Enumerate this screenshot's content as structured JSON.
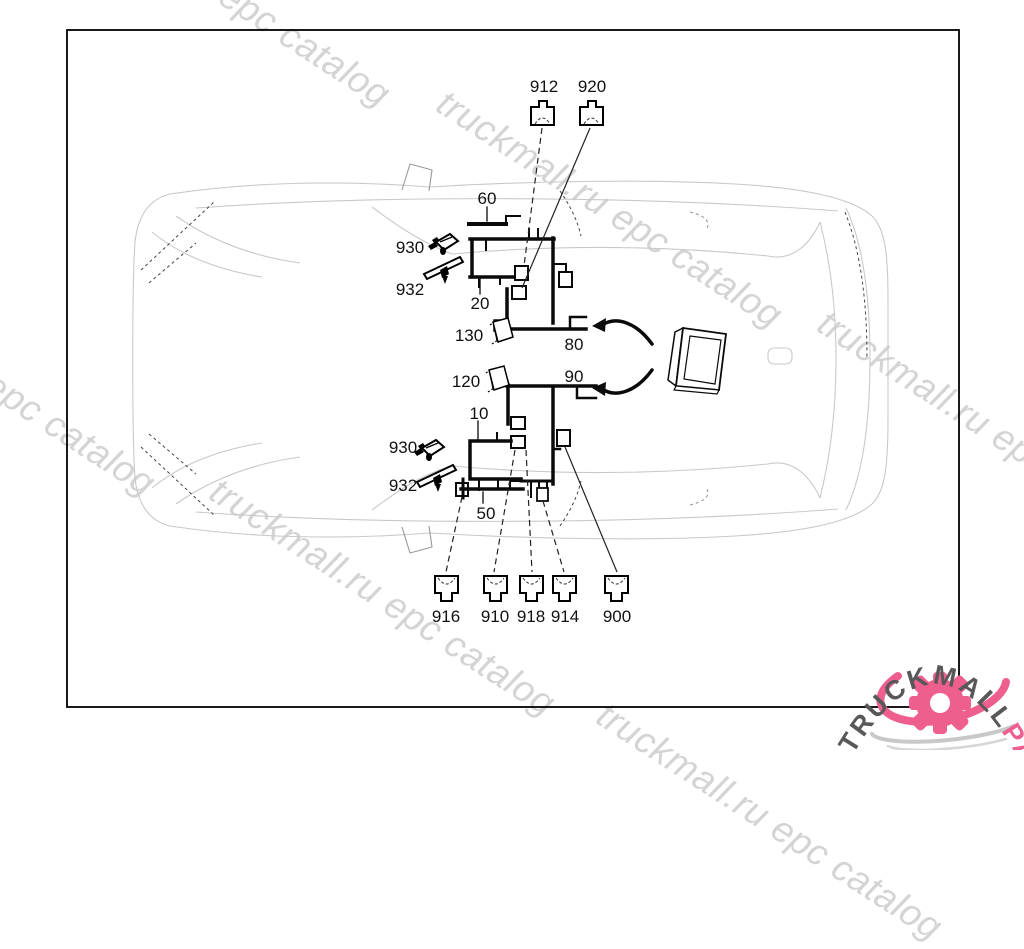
{
  "watermark": {
    "text": "truckmall.ru epc catalog",
    "color": "#d4d4d4"
  },
  "logo": {
    "part1": "TRUCKMALL",
    "part2": "PARTS",
    "gray": "#58585a",
    "accent": "#ee5f8d"
  },
  "callouts": {
    "n912": "912",
    "n920": "920",
    "n60": "60",
    "n20": "20",
    "n130": "130",
    "n80": "80",
    "n120": "120",
    "n90": "90",
    "n10": "10",
    "n50": "50",
    "n930a": "930",
    "n932a": "932",
    "n930b": "930",
    "n932b": "932",
    "n916": "916",
    "n910": "910",
    "n918": "918",
    "n914": "914",
    "n900": "900"
  }
}
